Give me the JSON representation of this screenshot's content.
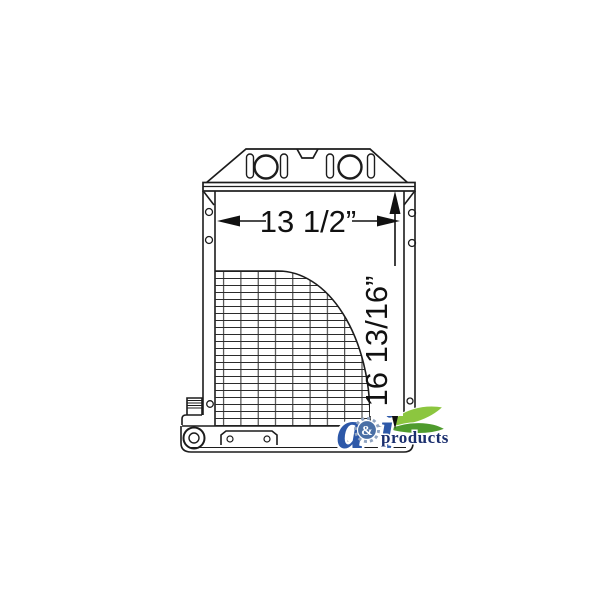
{
  "diagram": {
    "width_label": "13 1/2”",
    "height_label": "16 13/16”"
  },
  "logo": {
    "letter_a": "a",
    "ampersand": "&",
    "letter_i": "i",
    "products": "products",
    "colors": {
      "letter_blue": "#2d58a8",
      "navy": "#1b2f6e",
      "gear_body": "#4a6fa5",
      "gear_rim": "#8fa3c0",
      "leaf_light": "#8cc63f",
      "leaf_dark": "#4f9b2d",
      "sun_orange": "#f6a83c",
      "sun_yellow": "#fde27a"
    }
  }
}
